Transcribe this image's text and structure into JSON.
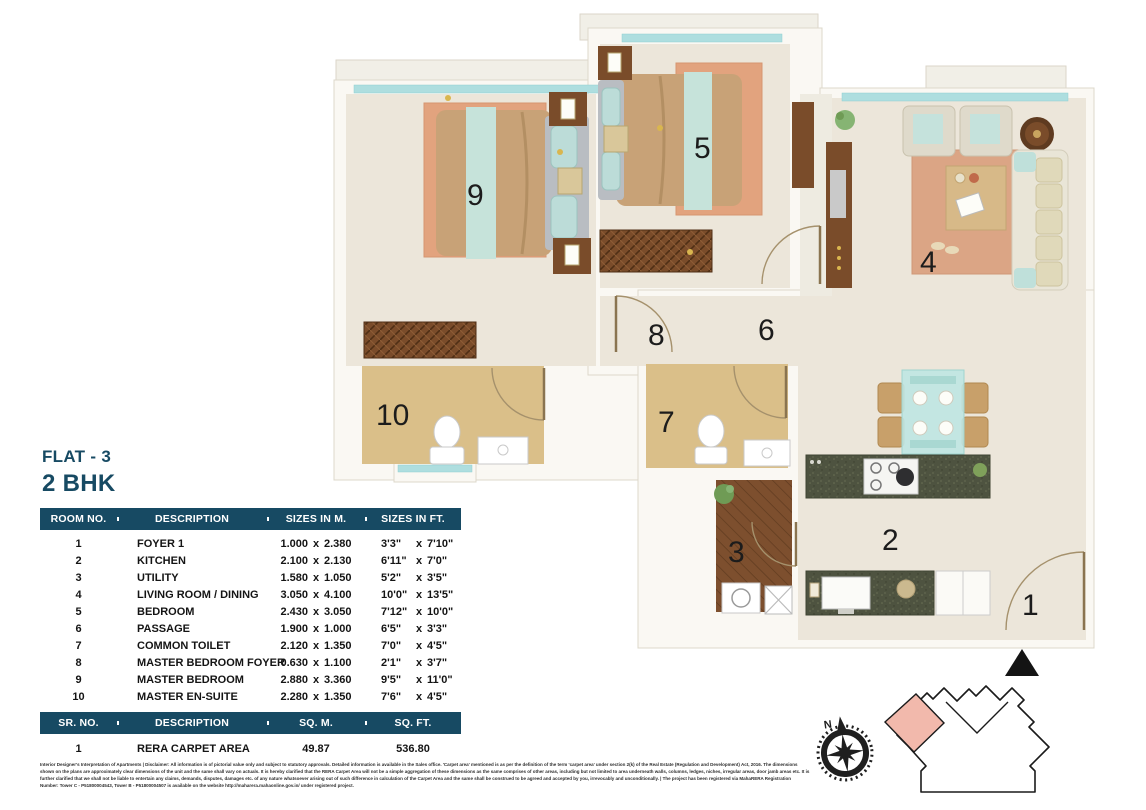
{
  "title": {
    "flat": "FLAT - 3",
    "bhk": "2 BHK"
  },
  "rooms_table": {
    "headers": {
      "no": "ROOM NO.",
      "desc": "DESCRIPTION",
      "m": "SIZES IN M.",
      "ft": "SIZES IN FT."
    },
    "x_sep": "x",
    "rows": [
      {
        "no": "1",
        "desc": "FOYER 1",
        "m1": "1.000",
        "m2": "2.380",
        "f1": "3'3\"",
        "f2": "7'10\""
      },
      {
        "no": "2",
        "desc": "KITCHEN",
        "m1": "2.100",
        "m2": "2.130",
        "f1": "6'11\"",
        "f2": "7'0\""
      },
      {
        "no": "3",
        "desc": "UTILITY",
        "m1": "1.580",
        "m2": "1.050",
        "f1": "5'2\"",
        "f2": "3'5\""
      },
      {
        "no": "4",
        "desc": "LIVING ROOM / DINING",
        "m1": "3.050",
        "m2": "4.100",
        "f1": "10'0\"",
        "f2": "13'5\""
      },
      {
        "no": "5",
        "desc": "BEDROOM",
        "m1": "2.430",
        "m2": "3.050",
        "f1": "7'12\"",
        "f2": "10'0\""
      },
      {
        "no": "6",
        "desc": "PASSAGE",
        "m1": "1.900",
        "m2": "1.000",
        "f1": "6'5\"",
        "f2": "3'3\""
      },
      {
        "no": "7",
        "desc": "COMMON TOILET",
        "m1": "2.120",
        "m2": "1.350",
        "f1": "7'0\"",
        "f2": "4'5\""
      },
      {
        "no": "8",
        "desc": "MASTER BEDROOM FOYER",
        "m1": "0.630",
        "m2": "1.100",
        "f1": "2'1\"",
        "f2": "3'7\""
      },
      {
        "no": "9",
        "desc": "MASTER BEDROOM",
        "m1": "2.880",
        "m2": "3.360",
        "f1": "9'5\"",
        "f2": "11'0\""
      },
      {
        "no": "10",
        "desc": "MASTER EN-SUITE",
        "m1": "2.280",
        "m2": "1.350",
        "f1": "7'6\"",
        "f2": "4'5\""
      }
    ]
  },
  "area_table": {
    "headers": {
      "no": "SR. NO.",
      "desc": "DESCRIPTION",
      "sqm": "SQ. M.",
      "sqft": "SQ. FT."
    },
    "rows": [
      {
        "no": "1",
        "desc": "RERA CARPET AREA",
        "sqm": "49.87",
        "sqft": "536.80"
      }
    ]
  },
  "plan": {
    "labels": {
      "foyer": "1",
      "kitchen": "2",
      "utility": "3",
      "living": "4",
      "bedroom": "5",
      "passage": "6",
      "common_toilet": "7",
      "master_foyer": "8",
      "master_bedroom": "9",
      "master_ensuite": "10"
    },
    "compass_north": "N"
  },
  "disclaimer": {
    "lines": [
      "Interior Designer's Interpretation of Apartments | Disclaimer: All information is of pictorial value only and subject to statutory approvals. Detailed information is available in the Sales office. 'Carpet area' mentioned is as per the definition of the term 'carpet area' under section 2(k) of the Real Estate (Regulation and Development) Act, 2016. The dimensions",
      "shown on the plans are approximately clear dimensions of the unit and the same shall vary on actuals. It is hereby clarified that the RERA Carpet Area will not be a simple aggregation of these dimensions as the same comprises of other areas, including but not limited to area underneath walls, columns, ledges, niches, irregular areas, door jamb areas etc. It is",
      "further clarified that we shall not be liable to entertain any claims, demands, disputes, damages etc. of any nature whatsoever arising out of such difference in calculation of the Carpet Area and the same shall be construed to be agreed and accepted by you, irrevocably and unconditionally. | The project has been registered via MahaRERA Registration",
      "Number: Tower C - P51800004543, Tower B - P51800004507 is available on the website http://maharera.mahaonline.gov.in/ under registered project."
    ]
  },
  "colors": {
    "accent_navy": "#174a63",
    "window_teal": "#aededf",
    "rug_salmon": "#e2a37e",
    "floor_cream": "#ece6da",
    "toilet_tan": "#dabf89",
    "wood_brown": "#7a4c2a",
    "counter_granite": "#4e5340",
    "keyplan_highlight": "#f2b9ac"
  }
}
